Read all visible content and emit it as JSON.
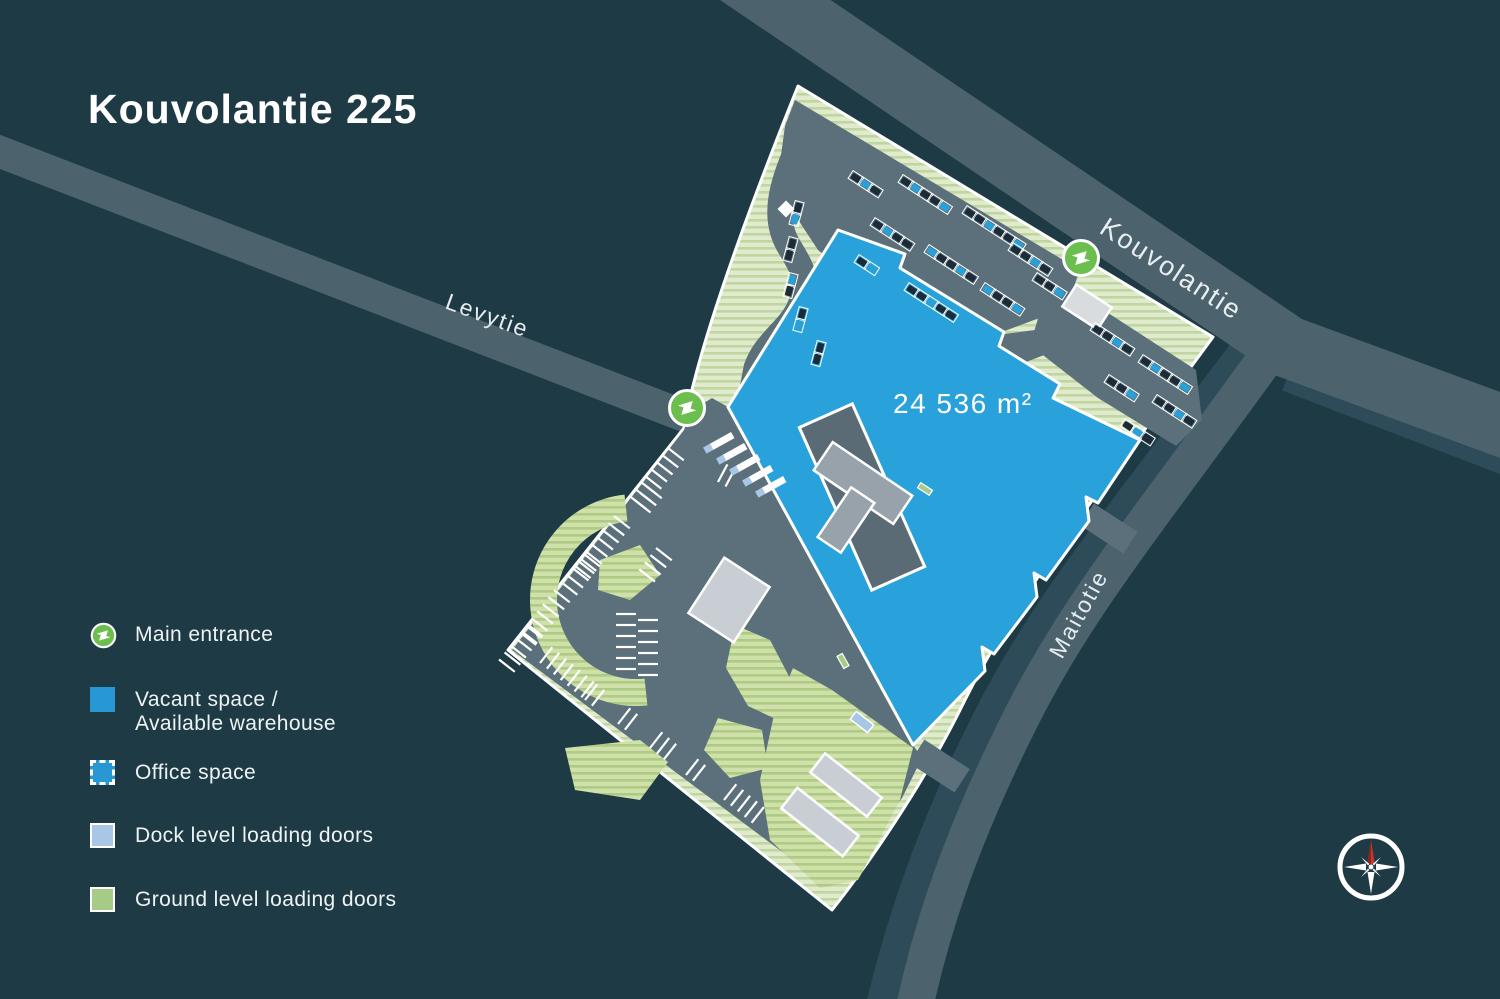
{
  "title": "Kouvolantie 225",
  "map": {
    "roads": {
      "levytie": "Levytie",
      "kouvolantie": "Kouvolantie",
      "maitotie": "Maitotie"
    },
    "area_label": "24 536 m²"
  },
  "legend": {
    "items": [
      {
        "id": "main-entrance",
        "label": "Main entrance"
      },
      {
        "id": "vacant-space",
        "label": "Vacant space /",
        "label2": "Available warehouse"
      },
      {
        "id": "office-space",
        "label": "Office space"
      },
      {
        "id": "dock-doors",
        "label": "Dock level loading doors"
      },
      {
        "id": "ground-doors",
        "label": "Ground level loading doors"
      }
    ]
  },
  "colors": {
    "background": "#1e3a45",
    "road": "#4c626d",
    "road_shadow": "#2d4b58",
    "asphalt": "#5b707a",
    "vacant_blue": "#29a2db",
    "dock_blue": "#a9c6e6",
    "ground_green": "#a5cb87",
    "entrance_green": "#6cbf4e",
    "site_green_base": "#e0eacd",
    "site_green_stripe": "#c0d6a0"
  }
}
